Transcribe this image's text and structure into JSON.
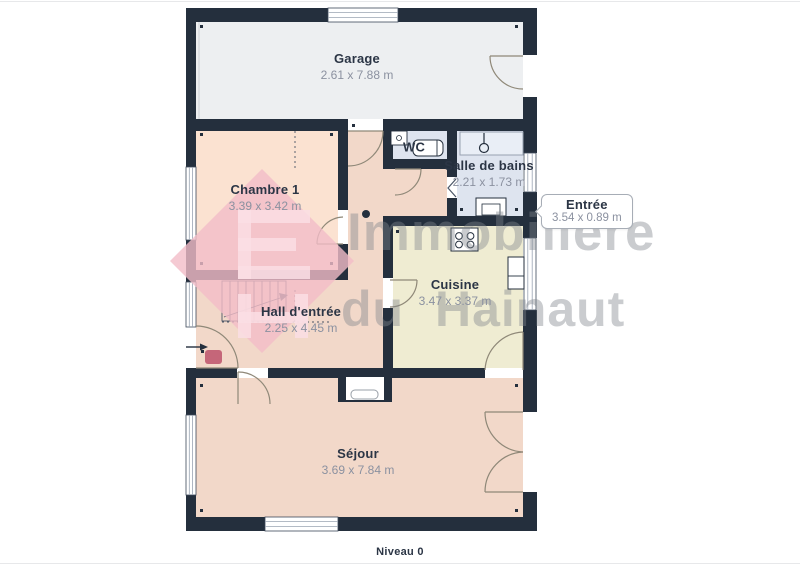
{
  "page": {
    "level_label": "Niveau 0"
  },
  "watermark": {
    "line1": "Immobilière",
    "line2": "du Hainaut",
    "logo": "immobiliere-du-hainaut-logo"
  },
  "rooms": [
    {
      "name": "Garage",
      "dims": "2.61 x 7.88 m"
    },
    {
      "name": "Chambre 1",
      "dims": "3.39 x 3.42 m"
    },
    {
      "name": "WC",
      "dims": ""
    },
    {
      "name": "Salle de bains",
      "dims": "2.21 x 1.73 m"
    },
    {
      "name": "Entrée",
      "dims": "3.54 x 0.89 m"
    },
    {
      "name": "Hall d'entrée",
      "dims": "2.25 x 4.45 m"
    },
    {
      "name": "Cuisine",
      "dims": "3.47 x 3.37 m"
    },
    {
      "name": "Séjour",
      "dims": "3.69 x 7.84 m"
    }
  ],
  "icons": {
    "stairs": "stairs-icon",
    "shower": "shower-icon",
    "toilet": "toilet-icon",
    "sink": "sink-icon",
    "stove": "stove-icon",
    "fridge": "fridge-icon",
    "fireplace": "fireplace-icon",
    "entry_arrow": "entry-arrow-icon",
    "door": "door-arc-icon",
    "window": "window-icon"
  },
  "colors": {
    "wall": "#242f3d",
    "garage_floor": "#edeff1",
    "bedroom_floor": "#fbe2d1",
    "hall_living_floor": "#f2d8c9",
    "kitchen_floor": "#efecd2",
    "bathroom_floor": "#dee4ef",
    "room_name_text": "#2b3545",
    "dims_text": "#8b91a0",
    "watermark_text": "#9aa0a6",
    "logo_pink": "#f3bdc8",
    "logo_dark_pink": "#c05a70"
  }
}
